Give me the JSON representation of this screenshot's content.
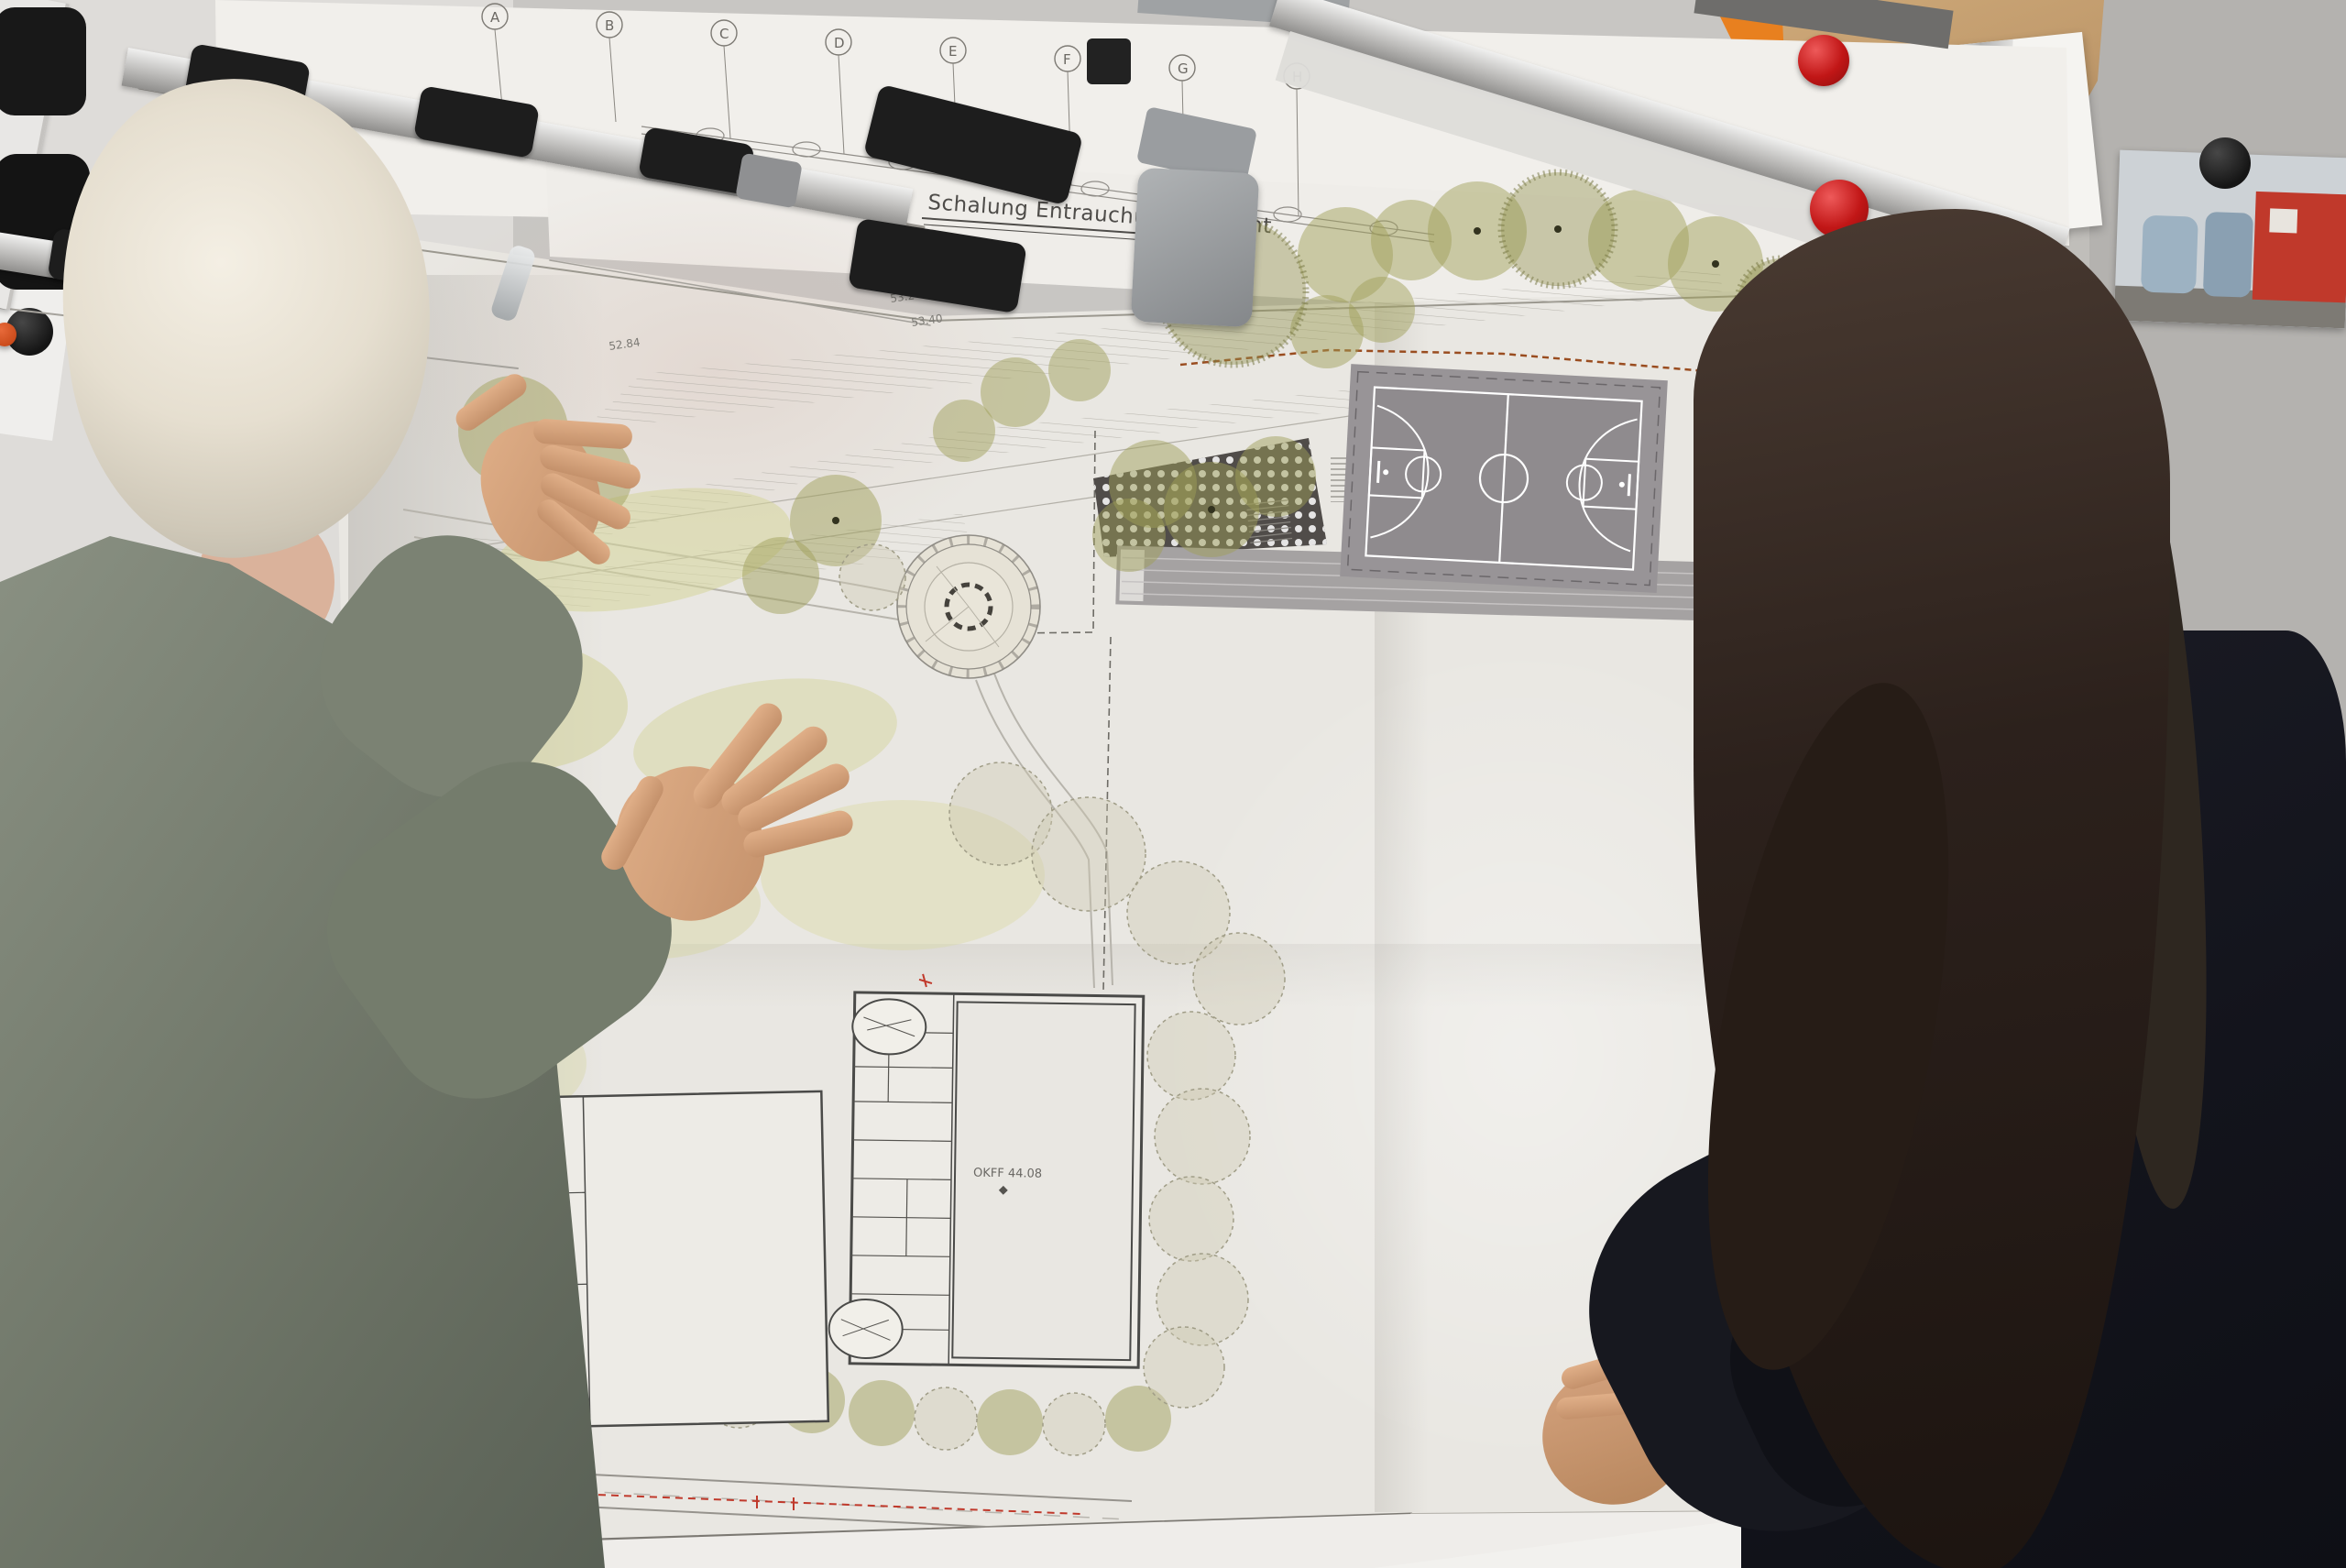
{
  "scene": {
    "description": "Two people discussing a large landscape-architecture site plan clipped to wall-mounted drawing rails",
    "man_label": "man with white hair in grey-green suit gesturing at the plan",
    "woman_label": "woman with long dark hair in a dark blazer, hands clasped"
  },
  "plan": {
    "title": "Schalung Entrauchungsschacht",
    "grid_letters": [
      "A",
      "B",
      "C",
      "D",
      "E",
      "F",
      "G",
      "H"
    ],
    "elevation_labels": [
      "52.84",
      "53.40",
      "53.2"
    ],
    "hall_label": "OKFF 44.08",
    "street_label": "straße"
  },
  "wall": {
    "poster_brand": "IKON",
    "poster_glyph": "Z"
  },
  "colors": {
    "tree_olive": "#9e9e58",
    "court_grey": "#989497",
    "magnet_red": "#c11616",
    "suit_green_grey": "#6d7467",
    "jacket_dark": "#14151d",
    "paper": "#e9e7e2"
  }
}
